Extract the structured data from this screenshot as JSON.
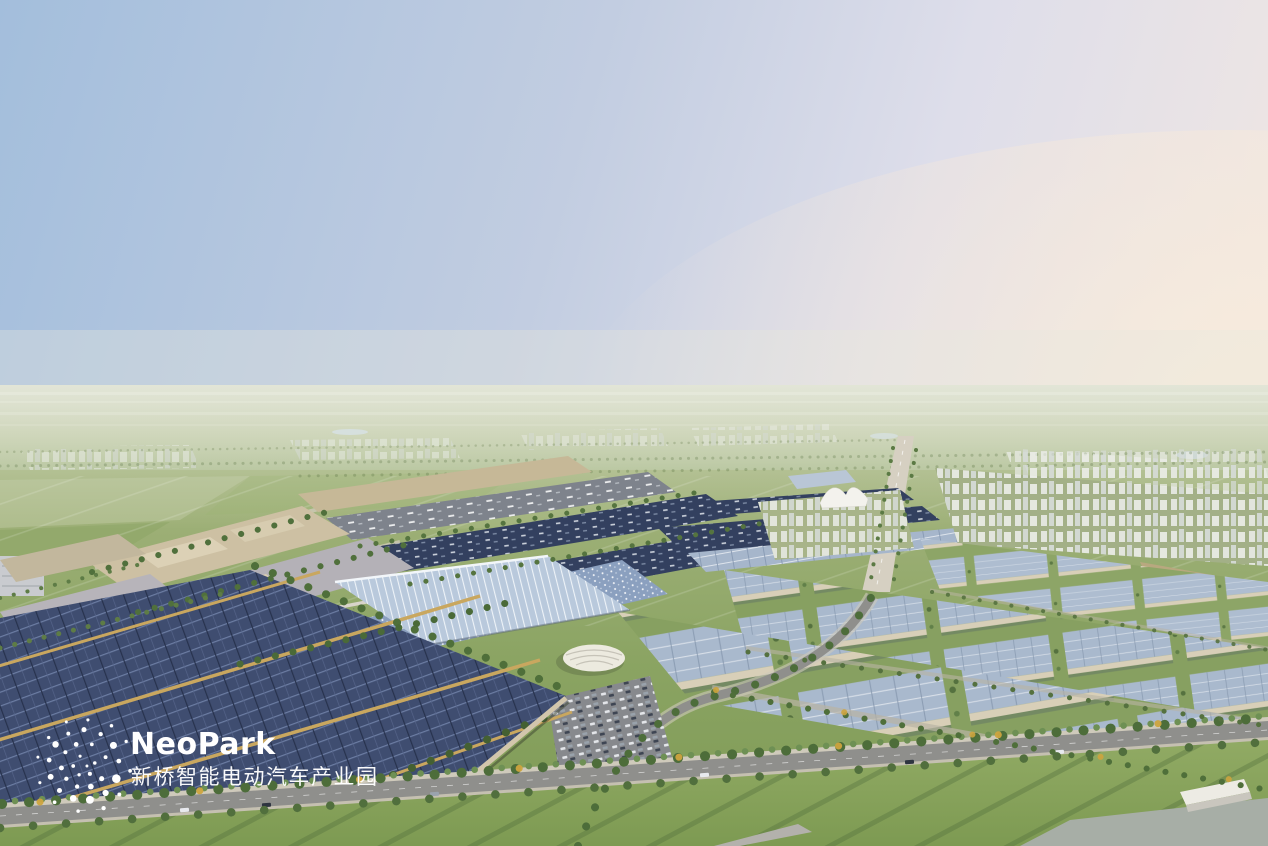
{
  "logo": {
    "wordmark": "NeoPark",
    "subtitle": "新桥智能电动汽车产业园",
    "mark_icon": "particle-dot-sphere",
    "color": "#ffffff"
  },
  "scene": {
    "type": "aerial-architectural-rendering",
    "subject": "NeoPark smart electric vehicle industrial park, bird's-eye view at dusk",
    "palette": {
      "sky_blue": "#a3bedc",
      "sky_dusk_pink": "#f6ecdd",
      "distant_fields": "#b2c094",
      "lawn_green": "#8aa55f",
      "solar_roof_dark": "#3f4d70",
      "solar_roof_light": "#a6b6cb",
      "roof_beige": "#cdc0a3",
      "ridge_gold": "#c9a75f",
      "road_asphalt": "#8f8f8c",
      "tree_green": "#4d6d3a"
    }
  }
}
